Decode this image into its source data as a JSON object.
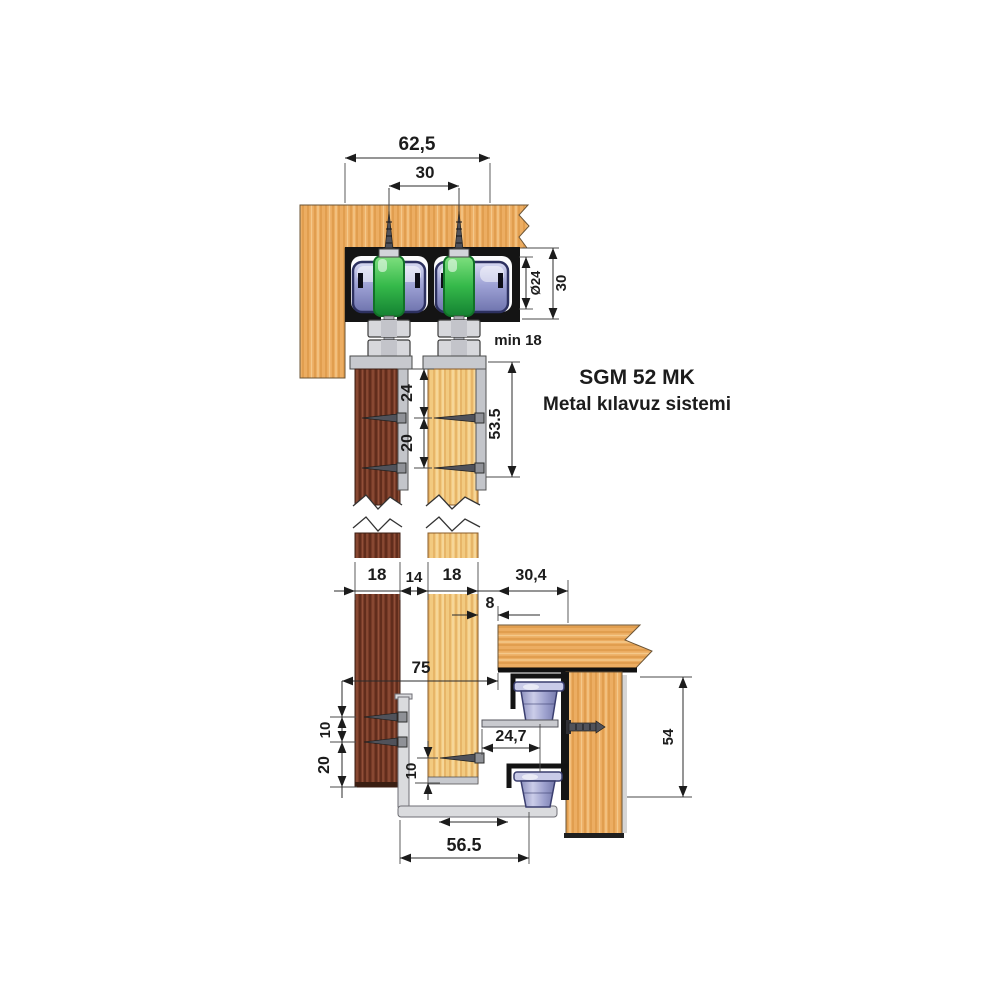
{
  "title": {
    "product": "SGM 52 MK",
    "subtitle": "Metal kılavuz sistemi"
  },
  "dims": {
    "top": {
      "total_width": "62,5",
      "roller_spacing": "30",
      "roller_diameter": "Ø24",
      "track_height": "30",
      "min_clearance": "min 18"
    },
    "hanger": {
      "screw_offset": "24",
      "screw_spacing": "20",
      "plate_height": "53.5"
    },
    "doors": {
      "left_thickness": "18",
      "gap": "14",
      "right_thickness": "18",
      "beam_offset": "30,4",
      "beam_gap": "8"
    },
    "bottom": {
      "floor_offset": "75",
      "screw_gap_upper": "10",
      "screw_gap_lower": "20",
      "door_clearance": "10",
      "guide_offset": "24,7",
      "profile_width": "56.5",
      "guide_height": "54"
    }
  },
  "colors": {
    "wood_orange": "#ECAD62",
    "wood_dark_door": "#7B3D29",
    "wood_light_door": "#F2CA80",
    "track_black": "#141414",
    "roller_green": "#2FAE42",
    "roller_lavender": "#9FA3D6",
    "metal_gray": "#DADBDE",
    "dimension_line": "#2B2B2B"
  }
}
